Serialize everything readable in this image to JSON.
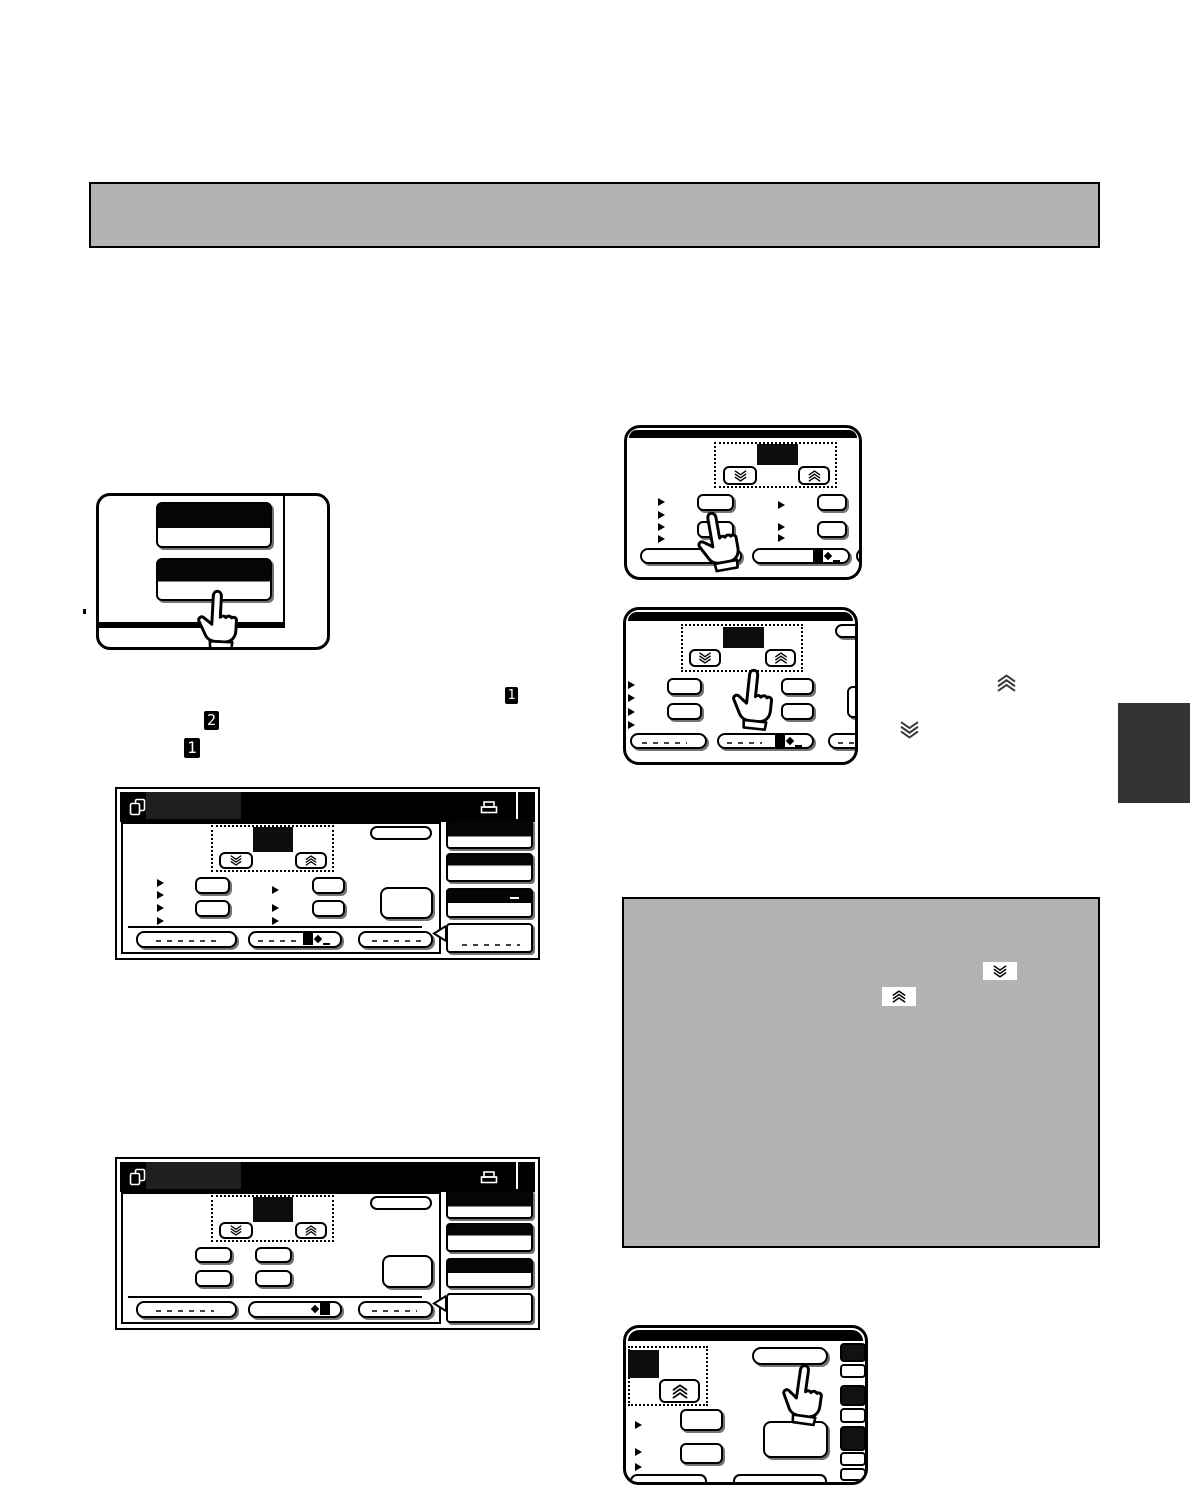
{
  "page": {
    "kind": "scanned-copier-manual-page",
    "background": "#ffffff",
    "note": "body text not rendered on scan; only figures, step badges and inline icons visible"
  },
  "colors": {
    "title_bar_fill": "#b3b3b3",
    "note_box_fill": "#b3b3b3",
    "side_tab_fill": "#333333",
    "ink": "#000000",
    "screen_header": "#000000"
  },
  "steps": {
    "step_1_inline": "1",
    "step_2": "2",
    "step_1": "1"
  },
  "icons": {
    "chevron_down": "triple-chevron-down",
    "chevron_up": "triple-chevron-up",
    "pointing_hand": "pointing-hand",
    "copy_document": "copy-document",
    "printer": "printer",
    "paper_feed": "paper-feed-indicator"
  }
}
